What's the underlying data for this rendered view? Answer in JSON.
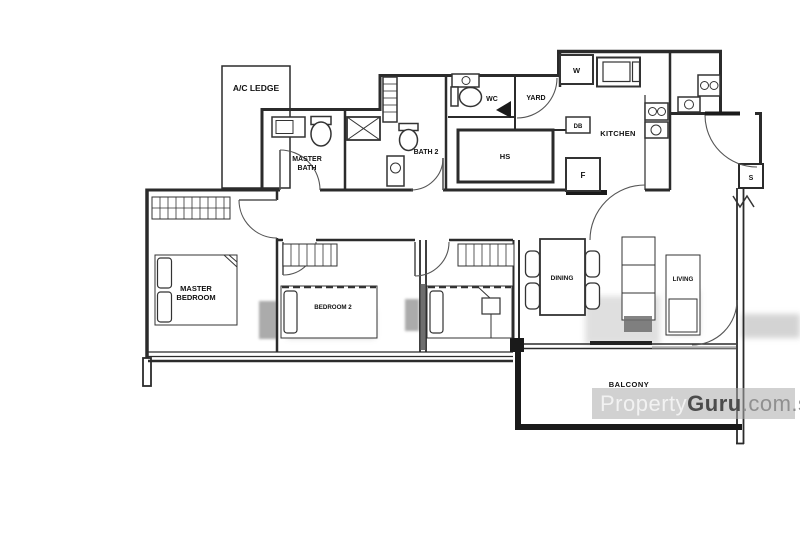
{
  "rooms": {
    "ac_ledge": "A/C LEDGE",
    "master_bath_l1": "MASTER",
    "master_bath_l2": "BATH",
    "bath2": "BATH 2",
    "wc": "WC",
    "yard": "YARD",
    "kitchen": "KITCHEN",
    "hs": "HS",
    "master_bedroom_l1": "MASTER",
    "master_bedroom_l2": "BEDROOM",
    "bedroom2": "BEDROOM 2",
    "dining": "DINING",
    "living": "LIVING",
    "balcony": "BALCONY"
  },
  "fixtures": {
    "washer": "W",
    "distribution_board": "DB",
    "fridge": "F",
    "shoe_cabinet": "S"
  },
  "watermark": {
    "brand_light": "Property",
    "brand_bold": "Guru",
    "brand_suffix": ".com.sg"
  },
  "colors": {
    "line": "#2b2b2b",
    "paper": "#ffffff",
    "watermark_bar": "rgba(172,172,172,0.55)"
  }
}
